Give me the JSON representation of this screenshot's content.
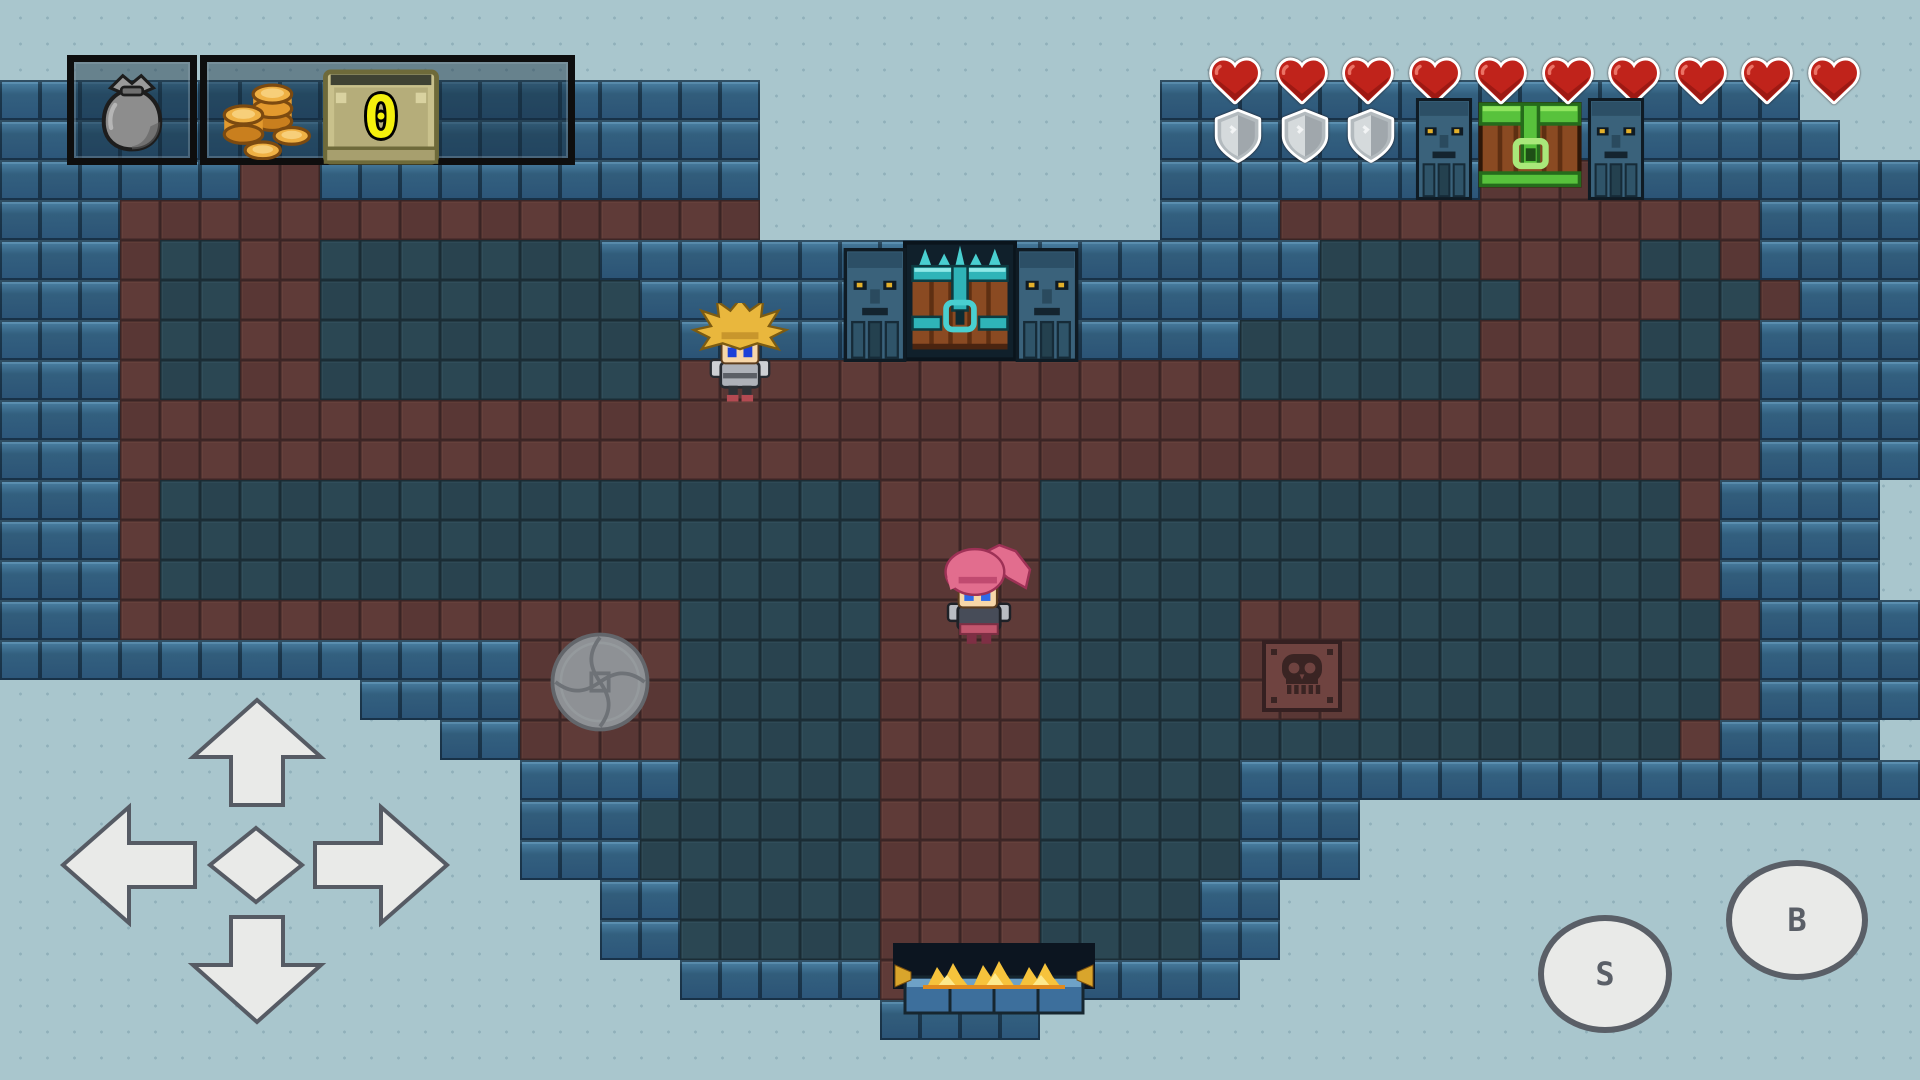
{
  "hud": {
    "inventory": {
      "icon": "bag-icon"
    },
    "currency": {
      "icon": "coins-icon",
      "count": "0"
    },
    "hearts": {
      "count": 10,
      "color": "#c0231b",
      "layout": {
        "x": 1208,
        "y": 56,
        "w": 54,
        "h": 50,
        "step": 66.5
      }
    },
    "shields": {
      "count": 3,
      "color": "#b3babe",
      "layout": {
        "x": 1212,
        "y": 106,
        "w": 52,
        "h": 60,
        "step": 66.5
      }
    }
  },
  "controls": {
    "dpad": {
      "directions": [
        "up",
        "left",
        "right",
        "down",
        "center"
      ]
    },
    "buttons": [
      {
        "id": "action-s",
        "label": "S"
      },
      {
        "id": "action-b",
        "label": "B"
      }
    ]
  },
  "entities": {
    "hud-bag-box": {
      "x": 67,
      "y": 55,
      "w": 130,
      "h": 110
    },
    "hud-coin-box": {
      "x": 200,
      "y": 55,
      "w": 375,
      "h": 110
    },
    "bag-icon": {
      "x": 88,
      "y": 68,
      "w": 88,
      "h": 86
    },
    "coins-icon": {
      "x": 214,
      "y": 70,
      "w": 104,
      "h": 90
    },
    "tan-chest": {
      "x": 322,
      "y": 64,
      "w": 118,
      "h": 106
    },
    "counter-zero": {
      "x": 322,
      "y": 68,
      "w": 118,
      "h": 98
    },
    "door-statue-left": {
      "x": 843,
      "y": 248,
      "w": 64,
      "h": 114
    },
    "top-door": {
      "x": 903,
      "y": 240,
      "w": 114,
      "h": 122
    },
    "door-statue-right": {
      "x": 1015,
      "y": 248,
      "w": 64,
      "h": 114
    },
    "chest-statue-left": {
      "x": 1411,
      "y": 98,
      "w": 66,
      "h": 102
    },
    "green-chest": {
      "x": 1477,
      "y": 86,
      "w": 106,
      "h": 114
    },
    "chest-statue-right": {
      "x": 1583,
      "y": 98,
      "w": 66,
      "h": 102
    },
    "bottom-exit": {
      "x": 893,
      "y": 943,
      "w": 202,
      "h": 72
    },
    "stone-disc": {
      "x": 546,
      "y": 628,
      "w": 108,
      "h": 108
    },
    "skull-tile": {
      "x": 1262,
      "y": 640,
      "w": 80,
      "h": 72
    },
    "hero-blonde": {
      "x": 688,
      "y": 303,
      "w": 104,
      "h": 100
    },
    "hero-pink": {
      "x": 926,
      "y": 540,
      "w": 106,
      "h": 108
    },
    "dpad": {
      "x": 55,
      "y": 695,
      "w": 400,
      "h": 340
    },
    "btn-s": {
      "x": 1538,
      "y": 915,
      "w": 134,
      "h": 118
    },
    "btn-b": {
      "x": 1726,
      "y": 860,
      "w": 142,
      "h": 120
    }
  },
  "map": {
    "tile_size": 40,
    "legend": {
      ".": "background",
      "W": "wall",
      "F": "floor",
      "R": "path"
    },
    "rows": [
      "................................................",
      "................................................",
      "WWWWWWWWWWWWWWWWWWW..........WWWWWWWWWWWWWWWW...",
      "WWWWWWWWWWWWWWWWWWW..........WWWWWWWWWWWWWWWWW..",
      "WWWWWWRRWWWWWWWWWWW..........WWWWWWWWRRRRWWWWWWW",
      "WWWRRRRRRRRRRRRRRRR..........WWWRRRRRRRRRRRRWWWW",
      "WWWRFFRRFFFFFFFWWWWWWWWWWWWWWWWWWFFFFRRRRFFRWWWW",
      "WWWRFFRRFFFFFFFFWWWWWWWWWWWWWWWWWFFFFFRRRRFFRWWWW",
      "WWWRFFRRFFFFFFFFFWWWWWWWWWWWWWWFFFFFFRRRRFFRWWWW",
      "WWWRFFRRFFFFFFFFFRRRRRRRRRRRRRRFFFFFFRRRRFFRWWWW",
      "WWWRRRRRRRRRRRRRRRRRRRRRRRRRRRRRRRRRRRRRRRRRWWWW",
      "WWWRRRRRRRRRRRRRRRRRRRRRRRRRRRRRRRRRRRRRRRRRWWWW",
      "WWWRFFFFFFFFFFFFFFFFFFRRRRFFFFFFFFFFFFFFFFRWWWW",
      "WWWRFFFFFFFFFFFFFFFFFFRRRRFFFFFFFFFFFFFFFFRWWWW",
      "WWWRFFFFFFFFFFFFFFFFFFRRRRFFFFFFFFFFFFFFFFRWWWW",
      "WWWRRRRRRRRRRRRRRFFFFFRRRRFFFFFRRRFFFFFFFFFRWWWW",
      "WWWWWWWWWWWWWRRRRFFFFFRRRRFFFFFRRRFFFFFFFFFRWWWW",
      ".........WWWWRRRRFFFFFRRRRFFFFFRRRFFFFFFFFFRWWWW",
      "...........WWRRRRFFFFFRRRRFFFFFFFFFFFFFFFFRWWWW",
      ".............WWWWFFFFFRRRRFFFFFWWWWWWWWWWWWWWWWW",
      ".............WWWFFFFFFRRRRFFFFFWWW..............",
      ".............WWWFFFFFFRRRRFFFFFWWW..............",
      "...............WWFFFFFRRRRFFFFWW................",
      "...............WWFFFFFRRRRFFFFWW................",
      ".................WWWWWRRRRWWWWW.................",
      "......................WWWW......................",
      "................................................"
    ]
  },
  "palette": {
    "bg": "#a9c6cd",
    "bg_dot": "#90b0ba",
    "wall": "#33607f",
    "wall_hi": "#4e86aa",
    "wall_line": "#0d1a24",
    "floor": "#2b4753",
    "floor_line": "#1b2d36",
    "path": "#5f3b38",
    "path_line": "#3d2626",
    "heart": "#c0231b",
    "shield": "#b3babe",
    "ui_gray": "#e9eae8",
    "ui_stroke": "#5a5f67",
    "gold": "#efb144",
    "counter": "#f4f00c"
  }
}
